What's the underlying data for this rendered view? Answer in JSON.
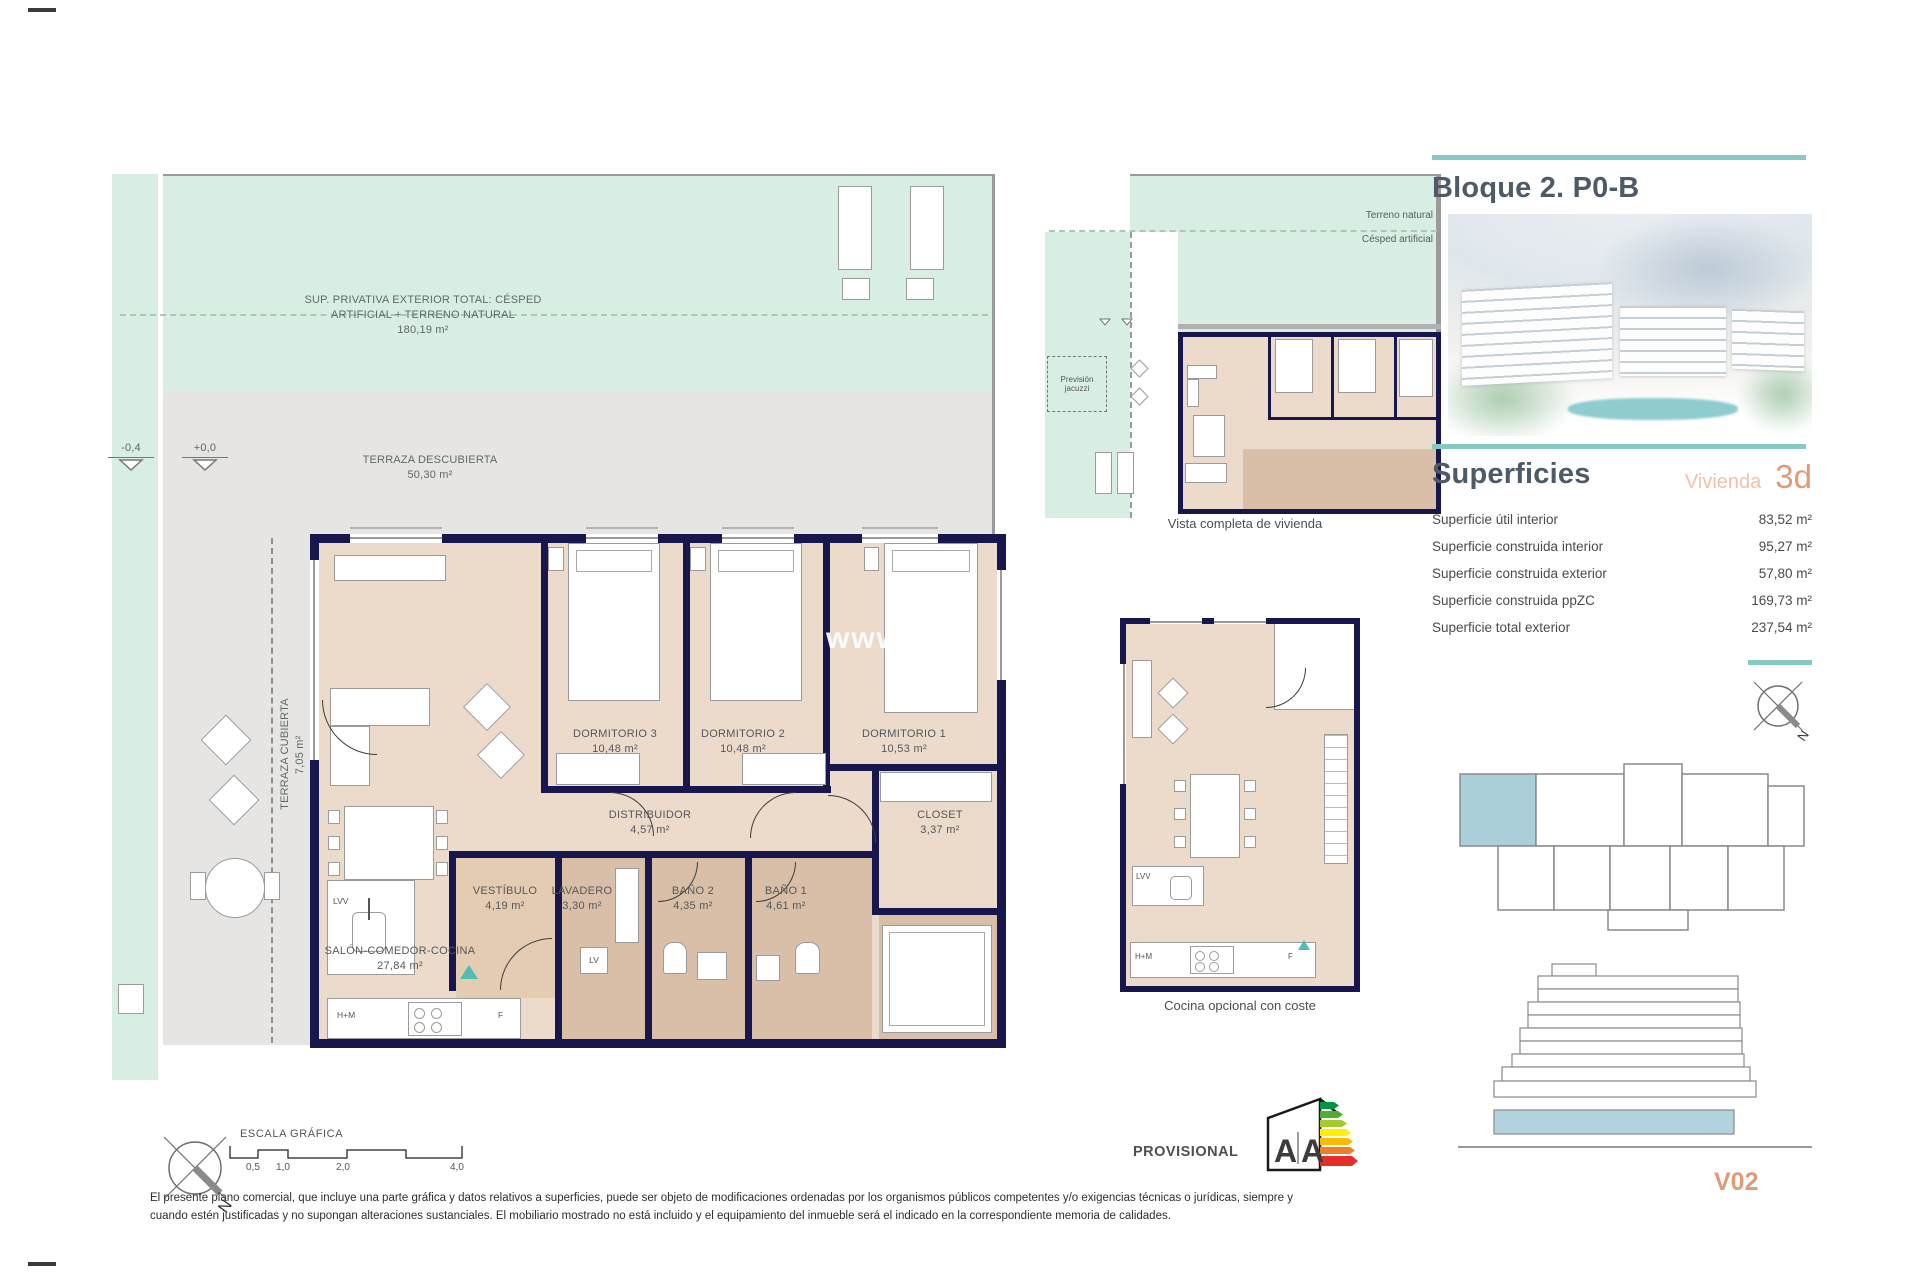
{
  "colors": {
    "accent_teal": "#85c8c4",
    "salmon": "#e09a78",
    "peach": "#eec3a9",
    "navy_wall": "#17174d",
    "room_beige": "#ecdbca",
    "wet_tan": "#d9bfa7",
    "lawn_mint": "#d9eee3",
    "terrace_gray": "#e6e5e3",
    "highlight_blue": "#abcfd9"
  },
  "header": {
    "title": "Bloque 2. P0-B"
  },
  "superficies": {
    "header": "Superficies",
    "vivienda_label": "Vivienda",
    "vivienda_type": "3d",
    "rows": [
      {
        "label": "Superficie útil interior",
        "value": "83,52 m²"
      },
      {
        "label": "Superficie construida interior",
        "value": "95,27 m²"
      },
      {
        "label": "Superficie construida exterior",
        "value": "57,80 m²"
      },
      {
        "label": "Superficie construida ppZC",
        "value": "169,73 m²"
      },
      {
        "label": "Superficie total exterior",
        "value": "237,54 m²"
      }
    ]
  },
  "plan": {
    "garden_label_line1": "SUP. PRIVATIVA EXTERIOR TOTAL: CÉSPED",
    "garden_label_line2": "ARTIFICIAL + TERRENO NATURAL",
    "garden_area": "180,19 m²",
    "terraza_descubierta": {
      "name": "TERRAZA DESCUBIERTA",
      "area": "50,30 m²"
    },
    "terraza_cubierta": {
      "name": "TERRAZA CUBIERTA",
      "area": "7,05 m²"
    },
    "levels": {
      "low": "-0,4",
      "high": "+0,0"
    },
    "rooms": [
      {
        "name": "DORMITORIO 3",
        "area": "10,48 m²"
      },
      {
        "name": "DORMITORIO 2",
        "area": "10,48 m²"
      },
      {
        "name": "DORMITORIO 1",
        "area": "10,53 m²"
      },
      {
        "name": "DISTRIBUIDOR",
        "area": "4,57 m²"
      },
      {
        "name": "CLOSET",
        "area": "3,37 m²"
      },
      {
        "name": "VESTÍBULO",
        "area": "4,19 m²"
      },
      {
        "name": "LAVADERO",
        "area": "3,30 m²"
      },
      {
        "name": "BAÑO 2",
        "area": "4,35 m²"
      },
      {
        "name": "BAÑO 1",
        "area": "4,61 m²"
      },
      {
        "name": "SALÓN-COMEDOR-COCINA",
        "area": "27,84 m²"
      }
    ],
    "labels": {
      "lvv": "LVV",
      "lv": "LV",
      "hm": "H+M",
      "f": "F"
    }
  },
  "overview": {
    "caption": "Vista completa de vivienda",
    "terreno": "Terreno natural",
    "cesped": "Césped artificial",
    "jacuzzi": {
      "line1": "Previsión",
      "line2": "jacuzzi"
    }
  },
  "kitchen_option": {
    "caption": "Cocina opcional con coste",
    "lvv": "LVV",
    "hm": "H+M",
    "f": "F"
  },
  "scale": {
    "title": "ESCALA GRÁFICA",
    "ticks": [
      "0,5",
      "1,0",
      "2,0",
      "4,0"
    ]
  },
  "compass": {
    "north": "N"
  },
  "energy": {
    "provisional": "PROVISIONAL",
    "letter_left": "A",
    "letter_right": "A"
  },
  "watermark": {
    "prefix": "www.",
    "suffix": "es"
  },
  "footer": {
    "disclaimer1": "El presente plano comercial, que incluye una parte gráfica y datos relativos a superficies, puede ser objeto de modificaciones ordenadas por los organismos públicos competentes y/o exigencias técnicas o jurídicas, siempre y",
    "disclaimer2": "cuando estén justificadas y no supongan alteraciones sustanciales. El mobiliario mostrado no está incluido y el equipamiento del inmueble será el indicado en la correspondiente memoria de calidades.",
    "version": "V02"
  }
}
